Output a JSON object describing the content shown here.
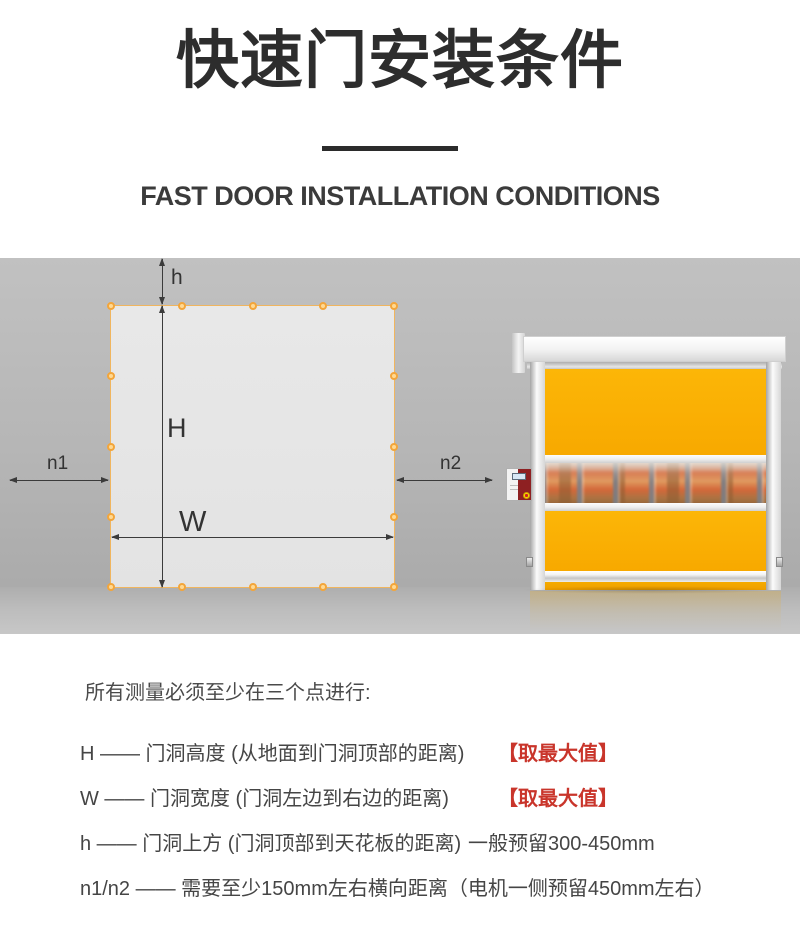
{
  "header": {
    "title": "快速门安装条件",
    "subtitle": "FAST DOOR INSTALLATION CONDITIONS"
  },
  "diagram": {
    "dimension_labels": {
      "h": "h",
      "H": "H",
      "W": "W",
      "n1": "n1",
      "n2": "n2"
    }
  },
  "notes": {
    "intro": "所有测量必须至少在三个点进行:",
    "items": [
      {
        "text": "H —— 门洞高度 (从地面到门洞顶部的距离)",
        "highlight": "【取最大值】"
      },
      {
        "text": "W —— 门洞宽度 (门洞左边到右边的距离)",
        "highlight": "【取最大值】"
      },
      {
        "text": "h —— 门洞上方 (门洞顶部到天花板的距离)",
        "note": "一般预留300-450mm"
      },
      {
        "text": "n1/n2 —— 需要至少150mm左右横向距离（电机一侧预留450mm左右）"
      }
    ]
  },
  "colors": {
    "door_yellow": "#F9AC00",
    "highlight_red": "#C9352B",
    "marker_orange": "#F3A53A",
    "wall_gray": "#B6B6B6"
  }
}
